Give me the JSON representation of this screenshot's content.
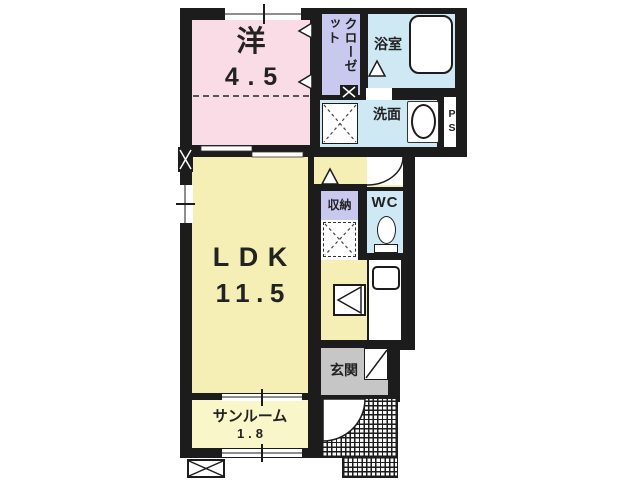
{
  "floorplan": {
    "type": "japanese-apartment-floorplan",
    "background_color": "#ffffff",
    "wall_color": "#1c1c1c",
    "rooms": {
      "western": {
        "label": "洋",
        "area": "4.5",
        "color": "#fadce6"
      },
      "closet": {
        "label": "クローゼット",
        "color": "#c9c9f0"
      },
      "bathroom": {
        "label": "浴室",
        "color": "#cfe9f4"
      },
      "washroom": {
        "label": "洗面",
        "color": "#cfe9f4"
      },
      "pipe_space": {
        "label": "PS",
        "color": "#ffffff"
      },
      "storage": {
        "label": "収納",
        "color": "#c9c9f0"
      },
      "wc": {
        "label": "WC",
        "color": "#cfe9f4"
      },
      "ldk": {
        "label": "LDK",
        "area": "11.5",
        "color": "#f6efb5"
      },
      "entrance": {
        "label": "玄関",
        "color": "#c6c6c6"
      },
      "sunroom": {
        "label": "サンルーム",
        "area": "1.8",
        "color": "#f9f6c9"
      }
    },
    "fixtures": [
      "bathtub",
      "wash-basin",
      "washing-machine-pan",
      "toilet",
      "kitchen-sink",
      "stove-unit",
      "refrigerator-space",
      "entrance-door",
      "porch-door-swing",
      "wc-door-swing",
      "outdoor-ac-unit",
      "windows",
      "sliding-door"
    ]
  }
}
